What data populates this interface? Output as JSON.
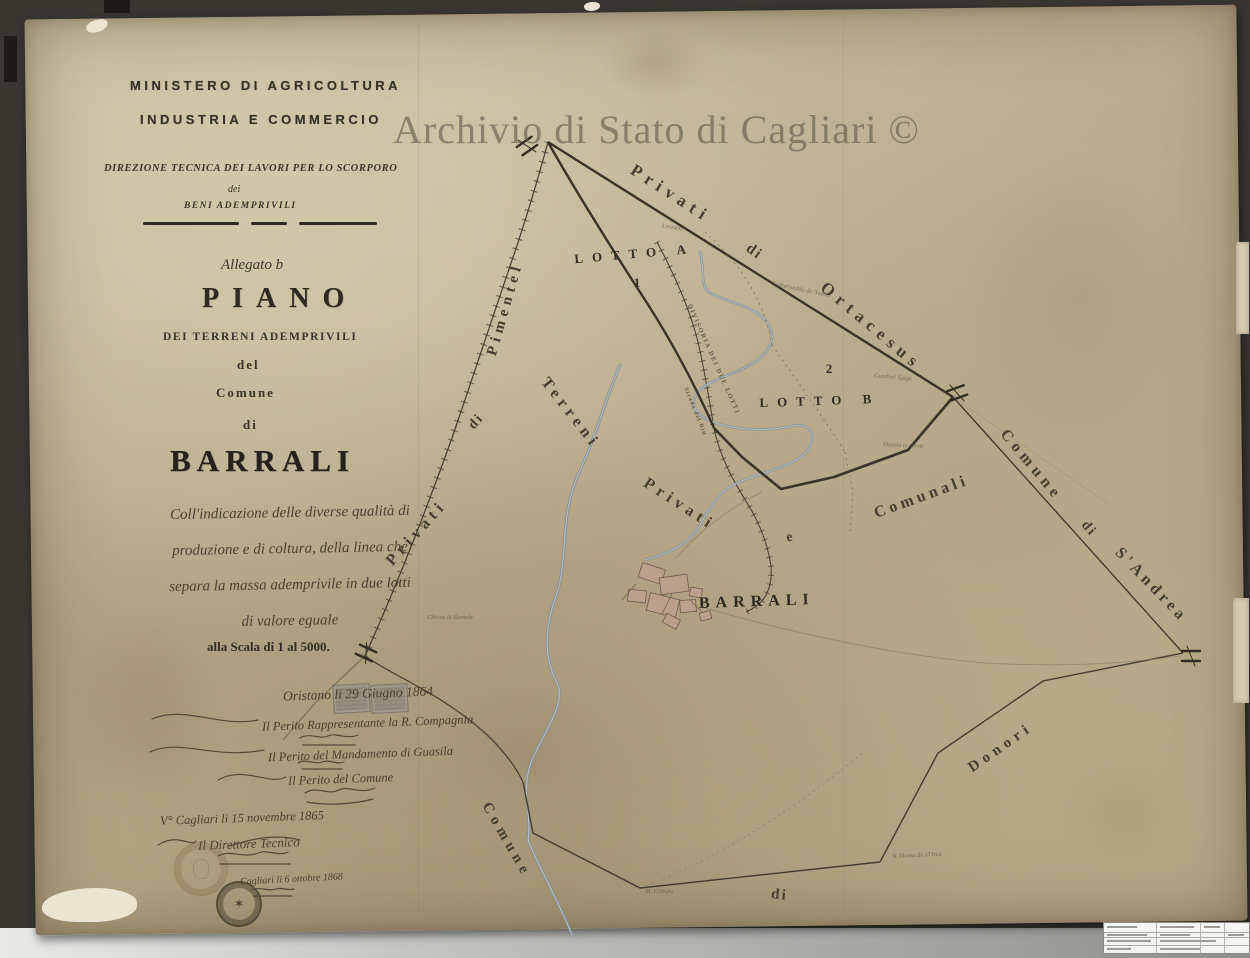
{
  "watermark": "Archivio di Stato di Cagliari ©",
  "colors": {
    "paper": "#c2b394",
    "ink": "#3f382d",
    "river": "#8795a0",
    "village_fill": "#bba08c",
    "scanner_bg": "#3a3733",
    "watermark": "#615b4c"
  },
  "header": {
    "ministry_line1": "MINISTERO DI AGRICOLTURA",
    "ministry_line2": "INDUSTRIA E COMMERCIO",
    "direction_line": "DIREZIONE TECNICA DEI LAVORI PER LO SCORPORO",
    "dei": "dei",
    "beni": "BENI ADEMPRIVILI"
  },
  "title_block": {
    "allegato": "Allegato b",
    "piano": "PIANO",
    "subtitle": "DEI TERRENI ADEMPRIVILI",
    "del": "del",
    "comune": "Comune",
    "di": "di",
    "barrali": "BARRALI",
    "description_lines": [
      "Coll'indicazione delle diverse qualità di",
      "produzione e di coltura, della linea che",
      "separa la massa ademprivile in due lotti",
      "di valore eguale"
    ],
    "scale": "alla Scala di 1 al 5000."
  },
  "handwriting": {
    "date_line": "Oristano li 29 Giugno 1864",
    "sig1_title": "Il Perito Rappresentante la R. Compagnia",
    "sig2_title": "Il Perito del Mandamento di Guasila",
    "sig3_title": "Il Perito del Comune",
    "visto_line": "V° Cagliari li 15 novembre 1865",
    "director_title": "Il Direttore Tecnico",
    "second_visto": "Cagliari li 6 ottobre 1868"
  },
  "map": {
    "labels": [
      {
        "t": "Privati",
        "x": 668,
        "y": 198,
        "r": 33,
        "s": 17,
        "ls": 6,
        "c": "area"
      },
      {
        "t": "di",
        "x": 752,
        "y": 255,
        "r": 35,
        "s": 15,
        "ls": 2,
        "c": "area"
      },
      {
        "t": "Ortacesus",
        "x": 868,
        "y": 330,
        "r": 40,
        "s": 17,
        "ls": 6,
        "c": "area"
      },
      {
        "t": "LOTTO A",
        "x": 635,
        "y": 258,
        "r": -5,
        "s": 13,
        "ls": 9,
        "c": "lotto"
      },
      {
        "t": "1",
        "x": 637,
        "y": 287,
        "r": 0,
        "s": 13,
        "ls": 0,
        "c": "lotto"
      },
      {
        "t": "LOTTO B",
        "x": 820,
        "y": 405,
        "r": -2,
        "s": 13,
        "ls": 9,
        "c": "lotto"
      },
      {
        "t": "2",
        "x": 829,
        "y": 373,
        "r": 0,
        "s": 13,
        "ls": 0,
        "c": "lotto"
      },
      {
        "t": "Comune",
        "x": 1028,
        "y": 468,
        "r": 50,
        "s": 16,
        "ls": 5,
        "c": "area"
      },
      {
        "t": "di",
        "x": 1086,
        "y": 531,
        "r": 50,
        "s": 14,
        "ls": 2,
        "c": "area"
      },
      {
        "t": "S'Andrea",
        "x": 1148,
        "y": 588,
        "r": 46,
        "s": 16,
        "ls": 4,
        "c": "area"
      },
      {
        "t": "Comunali",
        "x": 923,
        "y": 501,
        "r": -20,
        "s": 16,
        "ls": 4,
        "c": "area"
      },
      {
        "t": "e",
        "x": 790,
        "y": 541,
        "r": -8,
        "s": 14,
        "ls": 0,
        "c": "area"
      },
      {
        "t": "Privati",
        "x": 677,
        "y": 508,
        "r": 33,
        "s": 16,
        "ls": 5,
        "c": "area"
      },
      {
        "t": "BARRALI",
        "x": 757,
        "y": 606,
        "r": -2,
        "s": 16,
        "ls": 6,
        "c": "village"
      },
      {
        "t": "Terreni",
        "x": 567,
        "y": 416,
        "r": 52,
        "s": 16,
        "ls": 5,
        "c": "area"
      },
      {
        "t": "di",
        "x": 479,
        "y": 424,
        "r": -48,
        "s": 14,
        "ls": 2,
        "c": "area"
      },
      {
        "t": "Privati",
        "x": 420,
        "y": 536,
        "r": -48,
        "s": 16,
        "ls": 5,
        "c": "area"
      },
      {
        "t": "Pimentel",
        "x": 509,
        "y": 310,
        "r": -74,
        "s": 15,
        "ls": 5,
        "c": "area"
      },
      {
        "t": "Comune",
        "x": 503,
        "y": 842,
        "r": 60,
        "s": 15,
        "ls": 5,
        "c": "area"
      },
      {
        "t": "di",
        "x": 779,
        "y": 899,
        "r": 6,
        "s": 15,
        "ls": 2,
        "c": "area"
      },
      {
        "t": "Donori",
        "x": 1003,
        "y": 751,
        "r": -35,
        "s": 15,
        "ls": 5,
        "c": "area"
      },
      {
        "t": "DIVISORIA DEI DUE LOTTI",
        "x": 712,
        "y": 360,
        "r": 66,
        "s": 6.5,
        "ls": 1.5,
        "c": "road"
      },
      {
        "t": "Strada del Riu",
        "x": 694,
        "y": 412,
        "r": 68,
        "s": 6,
        "ls": 1,
        "c": "road"
      },
      {
        "t": "Leonaxi",
        "x": 672,
        "y": 229,
        "r": 8,
        "s": 6.5,
        "ls": 0,
        "c": "micro"
      },
      {
        "t": "Gutturixedda de Nebili",
        "x": 800,
        "y": 291,
        "r": 12,
        "s": 6.5,
        "ls": 0,
        "c": "micro"
      },
      {
        "t": "Cambiri Saigu",
        "x": 893,
        "y": 379,
        "r": 5,
        "s": 6.5,
        "ls": 0,
        "c": "micro"
      },
      {
        "t": "Mamia is aresti",
        "x": 903,
        "y": 447,
        "r": 3,
        "s": 6.5,
        "ls": 0,
        "c": "micro"
      },
      {
        "t": "Chiesa di Rumele",
        "x": 450,
        "y": 619,
        "r": 0,
        "s": 6.5,
        "ls": 0,
        "c": "micro"
      },
      {
        "t": "M. Craspu",
        "x": 659,
        "y": 893,
        "r": 0,
        "s": 6.5,
        "ls": 0,
        "c": "micro"
      },
      {
        "t": "N. Domu de s'Orcu",
        "x": 917,
        "y": 857,
        "r": -3,
        "s": 6.5,
        "ls": 0,
        "c": "micro"
      }
    ]
  }
}
